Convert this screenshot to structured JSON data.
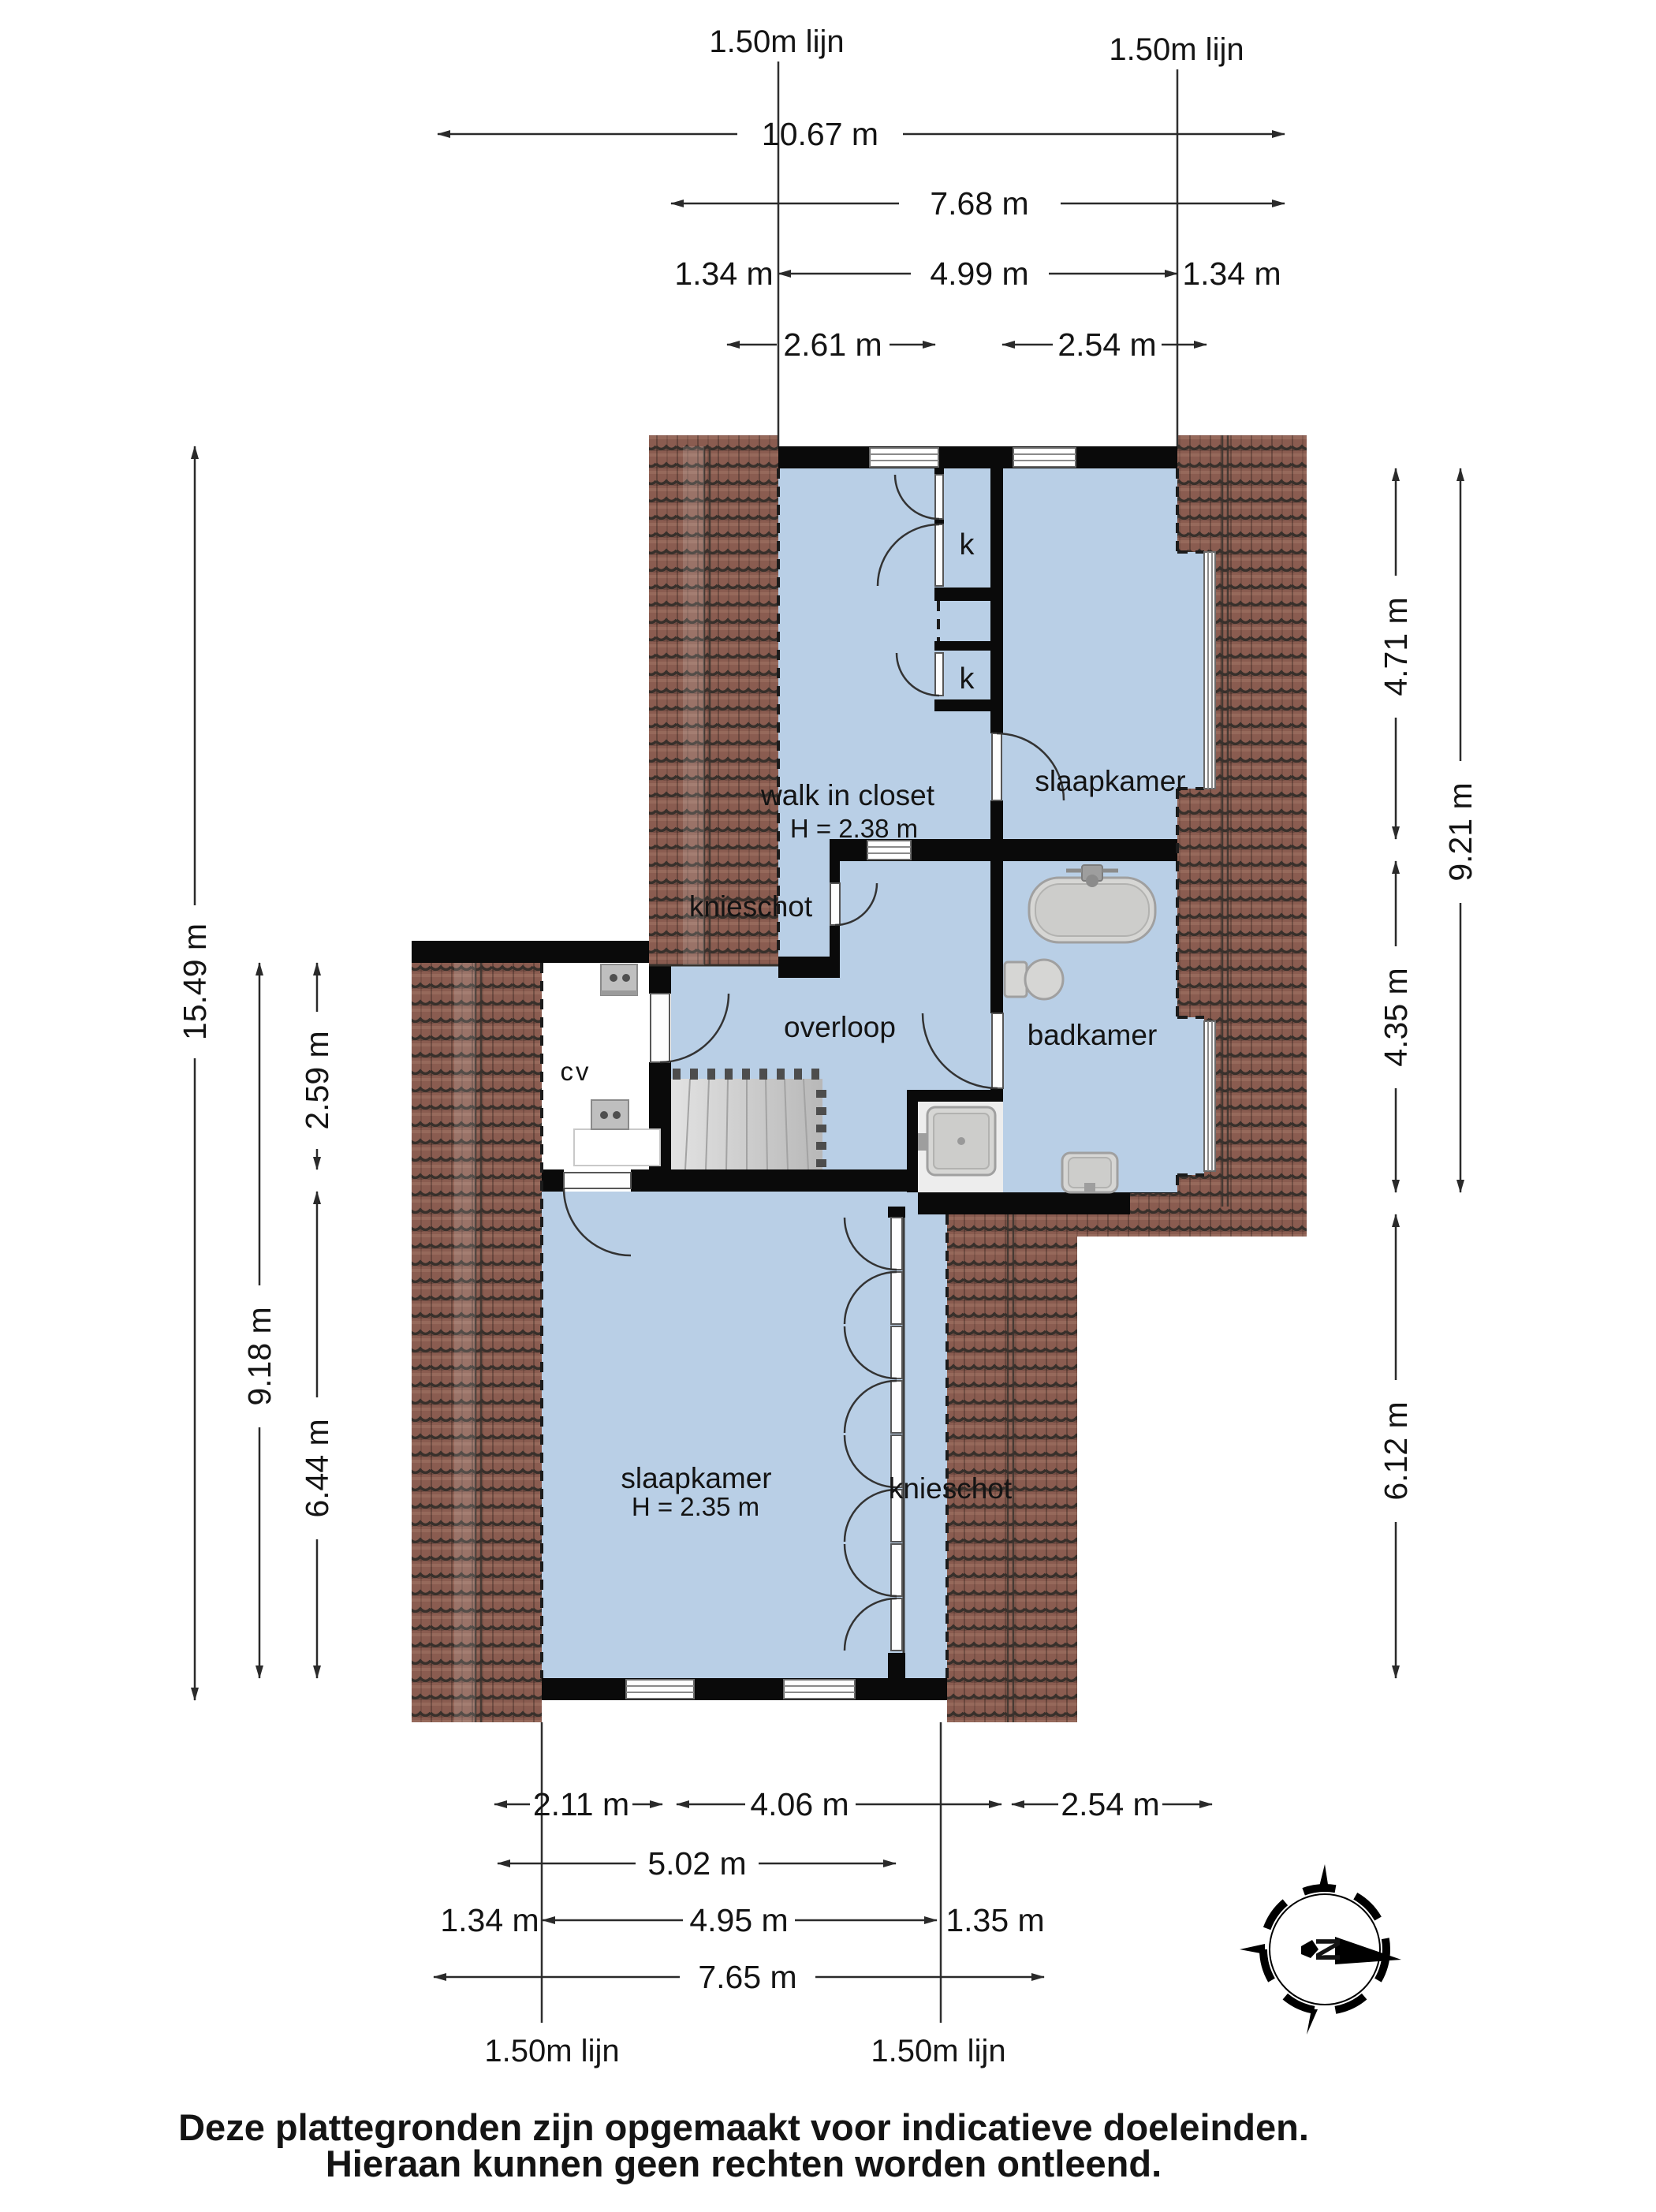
{
  "plan_type": "floor plan (verdieping)",
  "rooms": {
    "walk_in_closet": {
      "name": "walk in closet",
      "height": "H = 2.38 m"
    },
    "slaapkamer_boven": {
      "name": "slaapkamer"
    },
    "knieschot_boven": {
      "name": "knieschot"
    },
    "overloop": {
      "name": "overloop"
    },
    "badkamer": {
      "name": "badkamer"
    },
    "cv": {
      "name": "cv"
    },
    "slaapkamer_beneden": {
      "name": "slaapkamer",
      "height": "H = 2.35 m"
    },
    "knieschot_beneden": {
      "name": "knieschot"
    },
    "kast_1": {
      "name": "k"
    },
    "kast_2": {
      "name": "k"
    }
  },
  "dimensions": {
    "top": [
      "10.67 m",
      "7.68 m",
      "1.34 m",
      "4.99 m",
      "1.34 m",
      "2.61 m",
      "2.54 m"
    ],
    "left": [
      "15.49 m",
      "9.18 m",
      "2.59 m",
      "6.44 m"
    ],
    "right": [
      "4.71 m",
      "9.21 m",
      "4.35 m",
      "6.12 m"
    ],
    "bottom": [
      "2.11 m",
      "4.06 m",
      "2.54 m",
      "5.02 m",
      "1.34 m",
      "4.95 m",
      "1.35 m",
      "7.65 m"
    ]
  },
  "reference_lines": {
    "label": "1.50m lijn"
  },
  "compass": {
    "north": "N"
  },
  "footer": [
    "Deze plattegronden zijn opgemaakt voor indicatieve doeleinden.",
    "Hieraan kunnen geen rechten worden ontleend."
  ],
  "colors": {
    "floor": "#b9cfe6",
    "roof_tile": "#8a5c50",
    "wall": "#0a0a0a",
    "fixture": "#d6d6d4",
    "background": "#ffffff"
  }
}
